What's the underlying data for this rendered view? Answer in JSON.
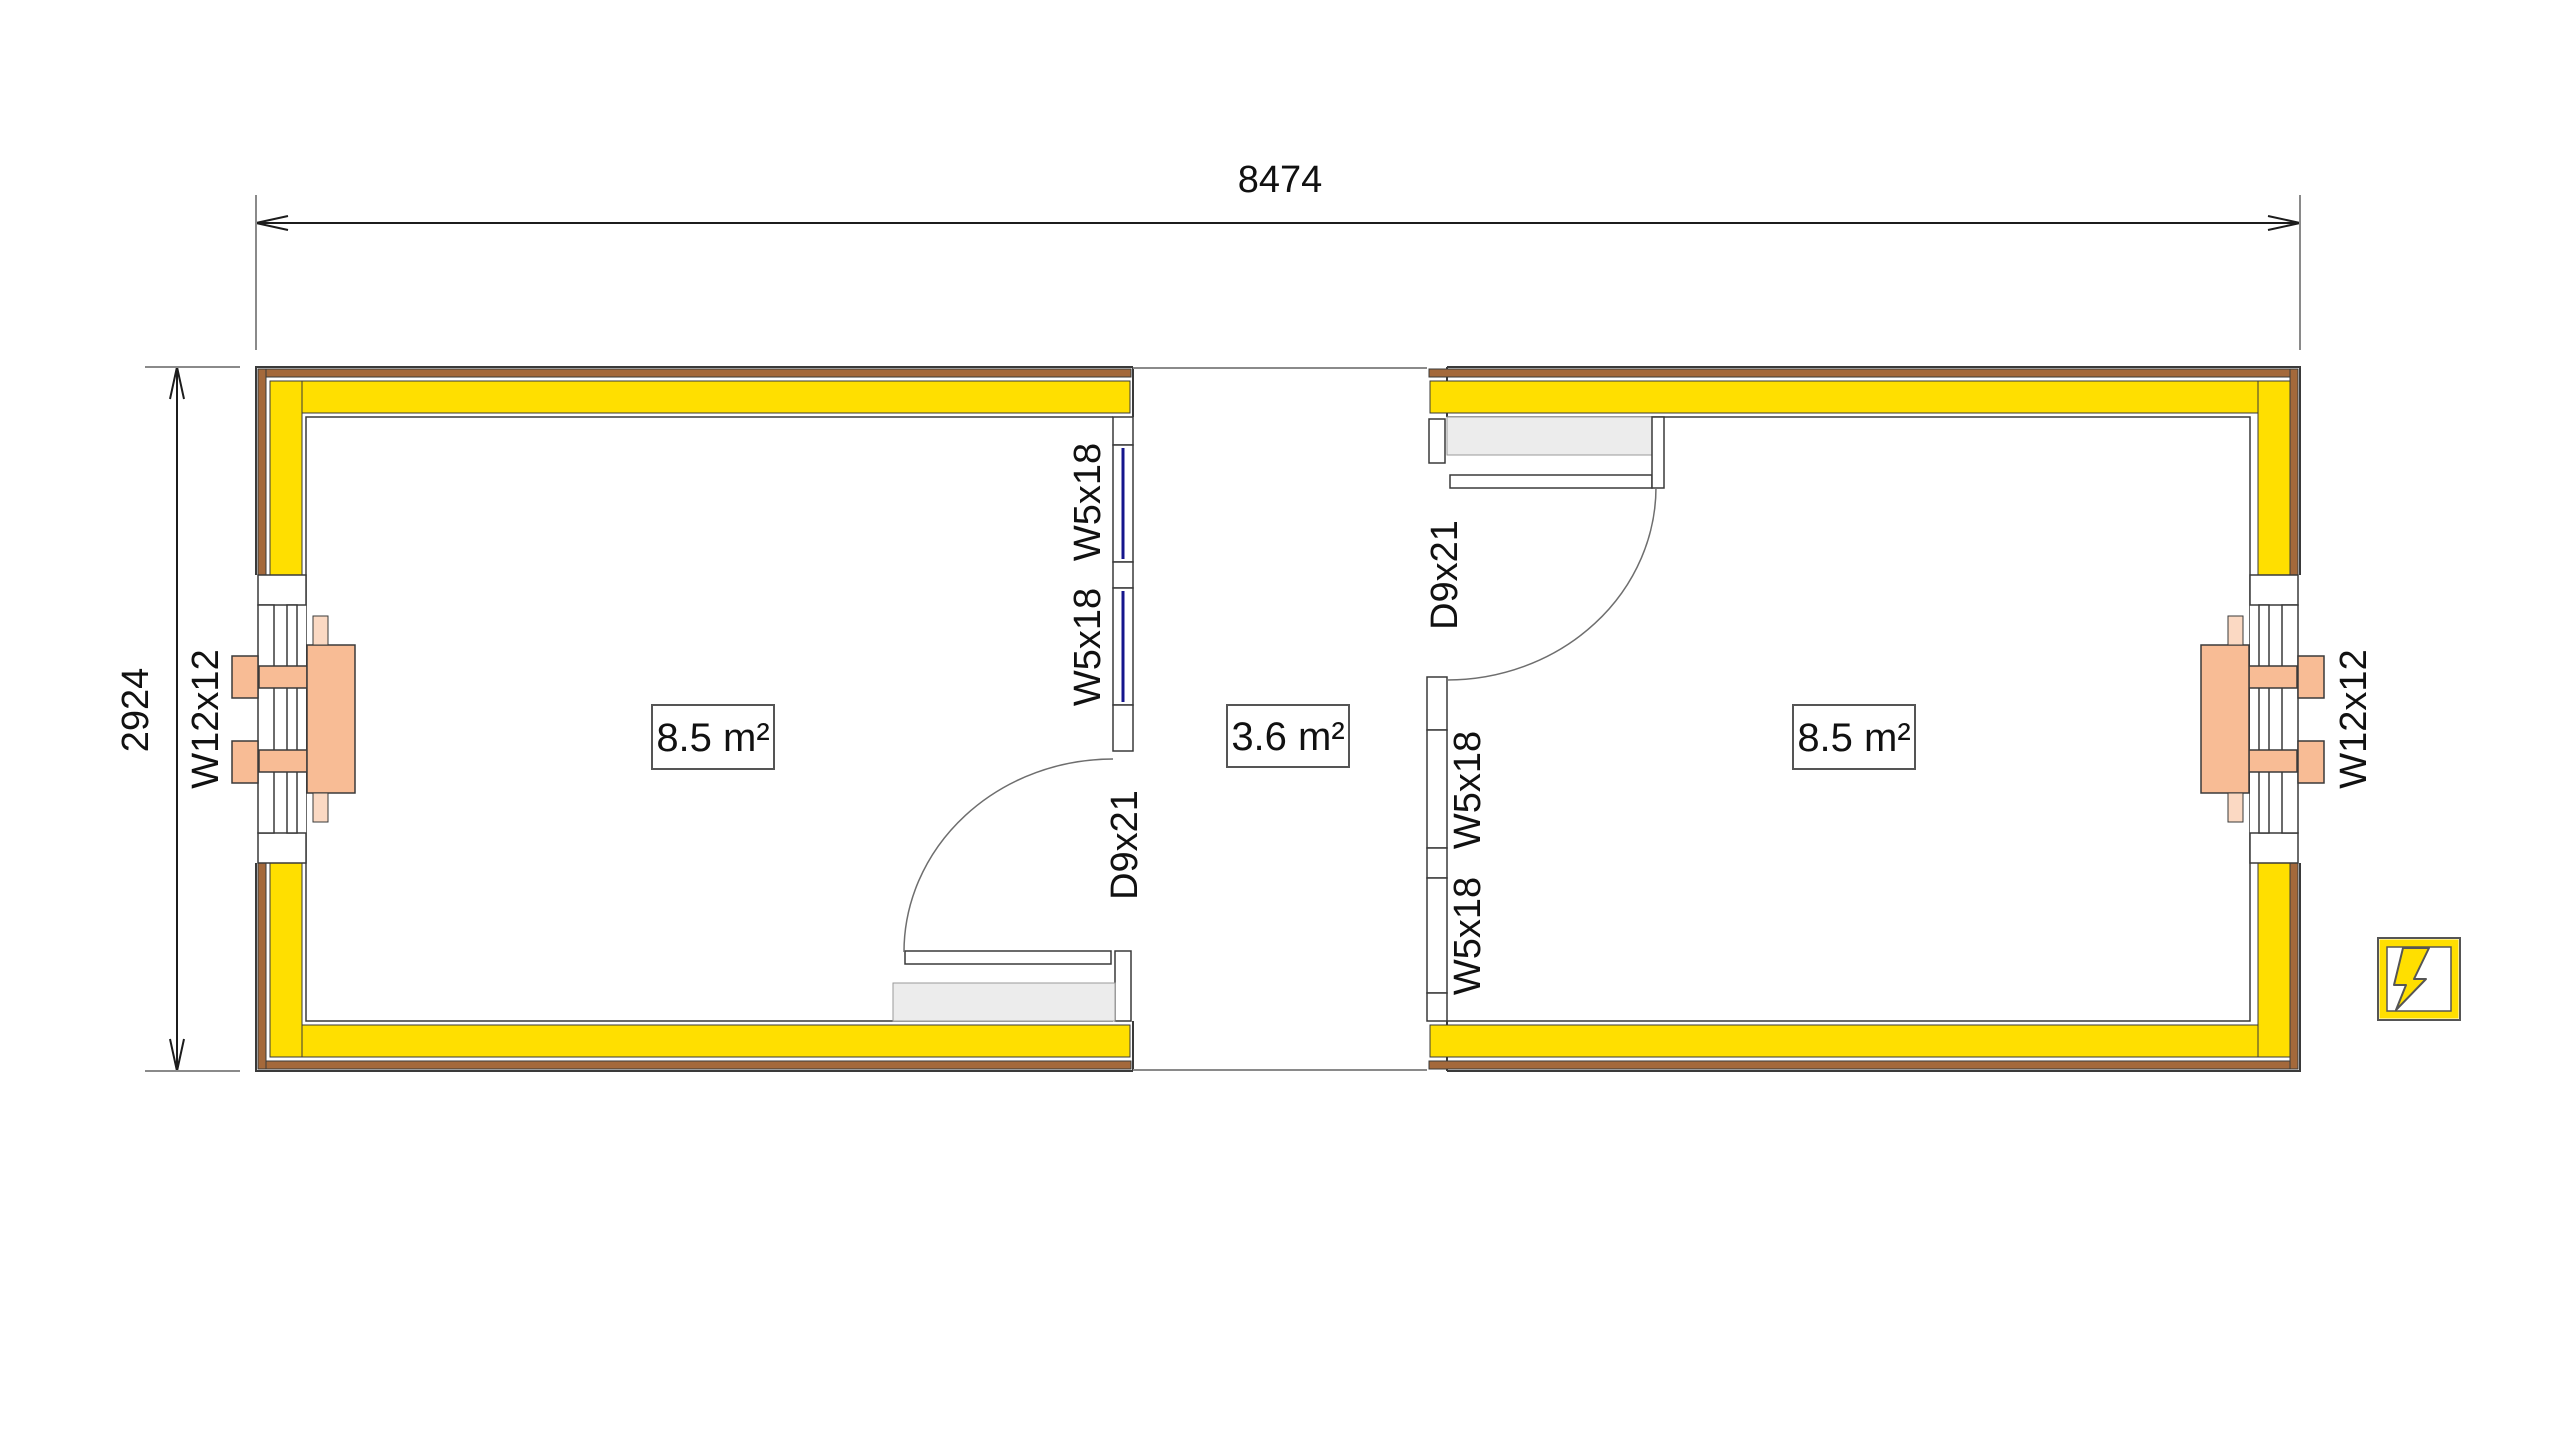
{
  "labels": {
    "overall_width": "8474",
    "overall_height": "2924",
    "window_large": "W12x12",
    "window_small": "W5x18",
    "door": "D9x21",
    "room_left_area": "8.5 m²",
    "terrace_area": "3.6 m²",
    "room_right_area": "8.5 m²"
  },
  "symbols": {
    "electric_symbol": "lightning-bolt"
  },
  "colors": {
    "insulation-yellow": "#FFDF00",
    "cladding-brown": "#A4693B",
    "fixture-salmon": "#F8BC95",
    "fixture-pink": "#FBD9C3",
    "glazing-blue": "#16168C",
    "door-gray": "#ECECEC",
    "line-dark": "#3A3A3A",
    "symbol-yellow": "#FFDF00"
  }
}
